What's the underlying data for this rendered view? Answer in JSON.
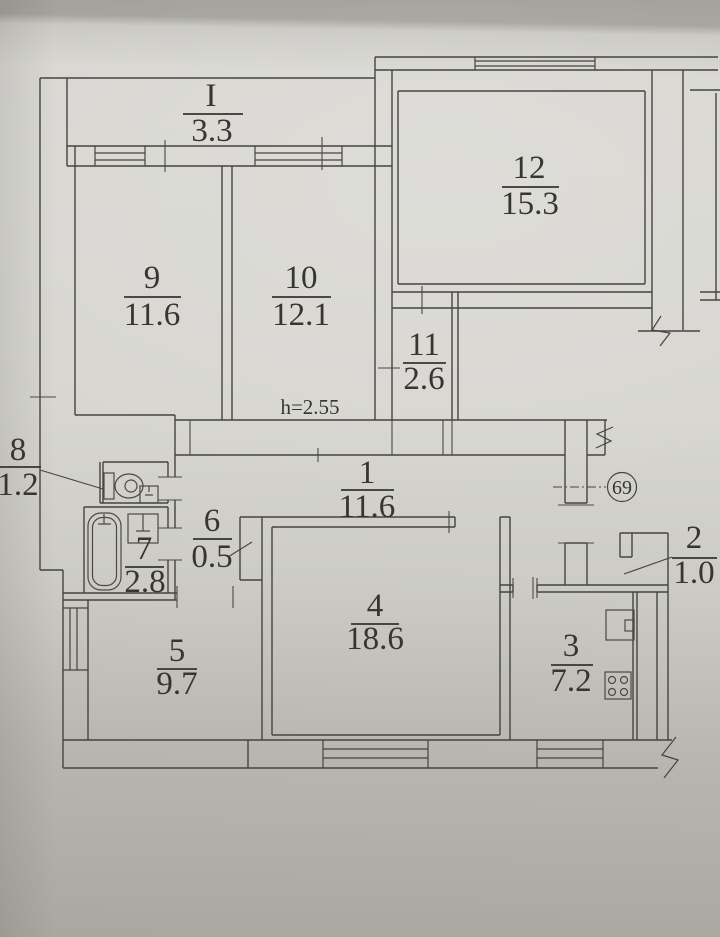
{
  "plan": {
    "title": "apartment floor plan",
    "apartment_number": "69",
    "ceiling_height_note": "h=2.55",
    "rooms": {
      "balcony": {
        "number": "I",
        "area": "3.3"
      },
      "room9": {
        "number": "9",
        "area": "11.6"
      },
      "room10": {
        "number": "10",
        "area": "12.1"
      },
      "room12": {
        "number": "12",
        "area": "15.3"
      },
      "room11": {
        "number": "11",
        "area": "2.6"
      },
      "hall1": {
        "number": "1",
        "area": "11.6"
      },
      "wc8": {
        "number": "8",
        "area": "1.2"
      },
      "bath7": {
        "number": "7",
        "area": "2.8"
      },
      "closet6": {
        "number": "6",
        "area": "0.5"
      },
      "room5": {
        "number": "5",
        "area": "9.7"
      },
      "room4": {
        "number": "4",
        "area": "18.6"
      },
      "vestibule2": {
        "number": "2",
        "area": "1.0"
      },
      "kitchen3": {
        "number": "3",
        "area": "7.2"
      }
    },
    "colors": {
      "paper": "#d7d6d1",
      "ink": "#45443f",
      "top_band": "#a09e99",
      "bottom_shade": "#a9a8a0"
    }
  }
}
